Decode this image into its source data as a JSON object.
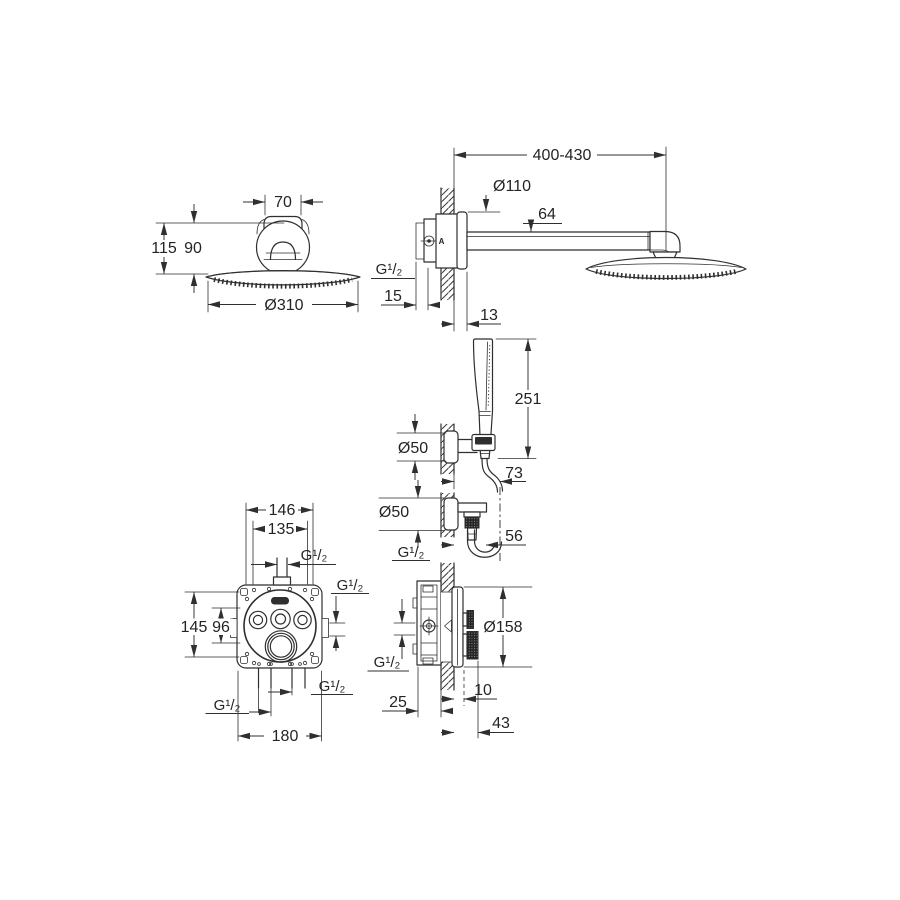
{
  "colors": {
    "line": "#2f2f2f",
    "text": "#242424",
    "background": "#ffffff",
    "knurl_fill": "#242424"
  },
  "views": {
    "head_front": {
      "dims": {
        "neck_width": "70",
        "total_height": "115",
        "dome_height": "90",
        "head_diameter": "Ø310"
      }
    },
    "head_side": {
      "marking": "A",
      "dims": {
        "arm_length": "400-430",
        "wall_plate_diameter": "Ø110",
        "arm_height": "64",
        "inlet_thread": "G¹/₂",
        "rough_in_depth": "15",
        "plate_offset": "13"
      }
    },
    "hand_shower": {
      "dims": {
        "handle_length": "251",
        "holder_diameter": "Ø50",
        "holder_offset": "73",
        "outlet_diameter": "Ø50",
        "outlet_offset": "56",
        "outlet_thread": "G¹/₂"
      }
    },
    "mixer_front": {
      "dims": {
        "hole_spacing_h": "146",
        "box_width": "135",
        "top_port_thread": "G¹/₂",
        "side_port_thread": "G¹/₂",
        "box_height": "145",
        "hole_spacing_v": "96",
        "bottom_right_thread": "G¹/₂",
        "bottom_left_thread": "G¹/₂",
        "plate_width": "180"
      }
    },
    "mixer_side": {
      "dims": {
        "plate_diameter": "Ø158",
        "plate_depth": "10",
        "rough_in_depth": "25",
        "total_projection": "43",
        "side_thread": "G¹/₂"
      }
    }
  }
}
